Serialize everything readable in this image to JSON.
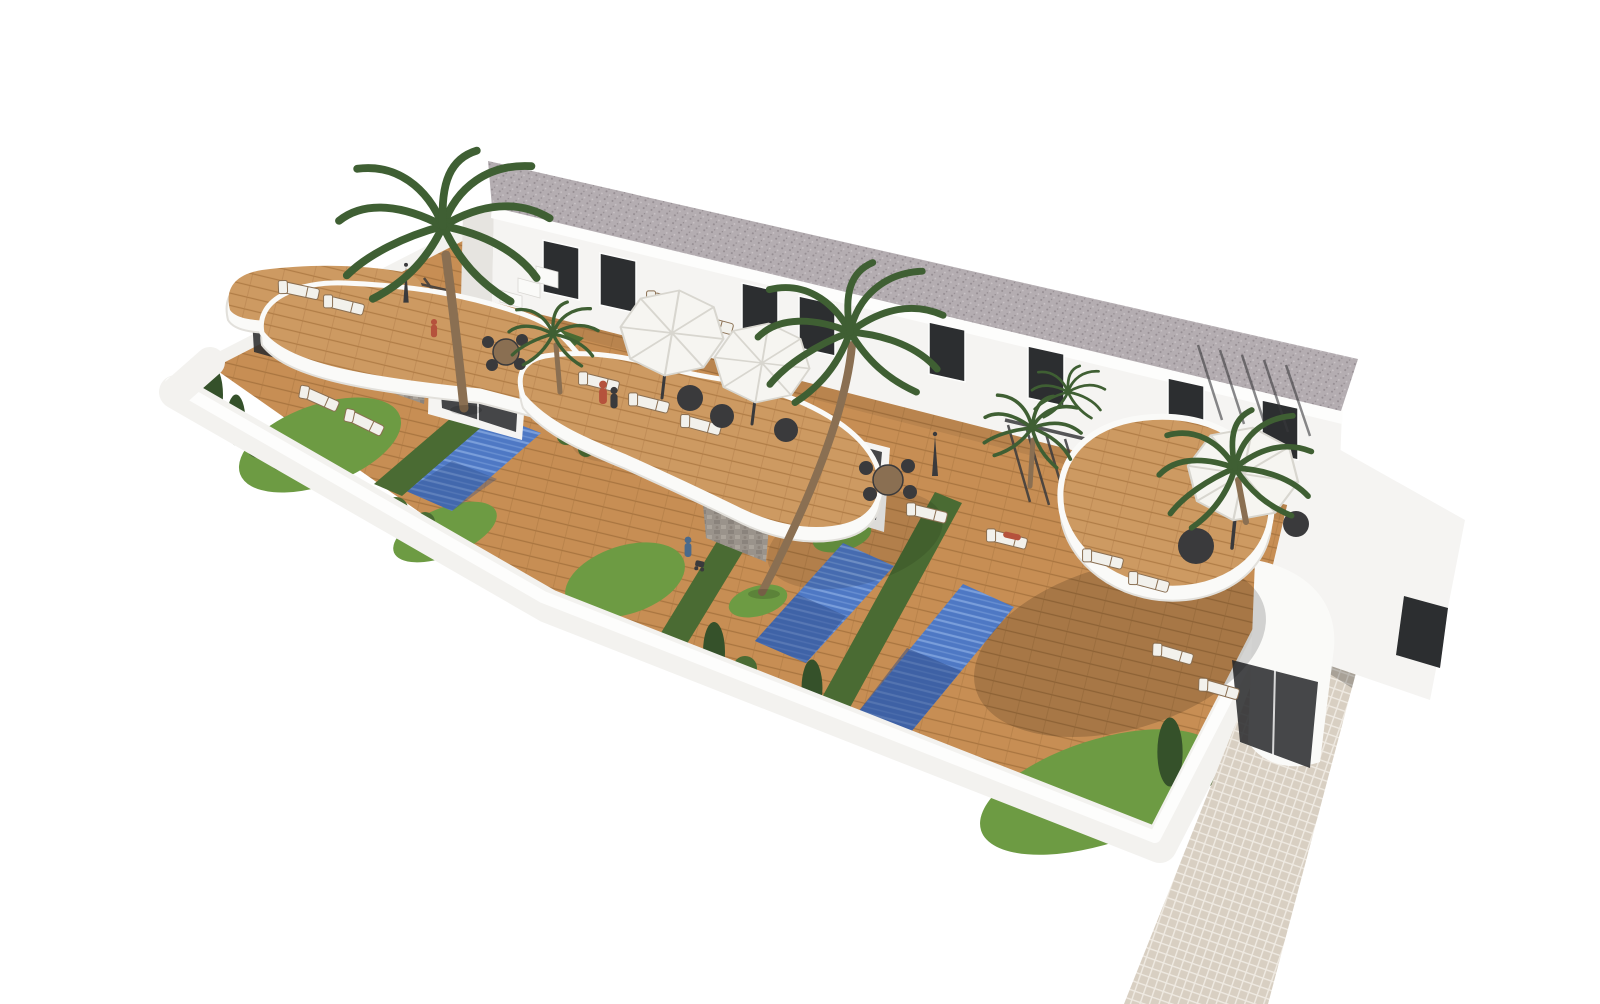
{
  "scene": {
    "type": "architectural-3d-render",
    "description": "Aerial 3D architectural rendering of a modern white two-storey townhouse development: a long flat-roofed block with gravel roof, dark windows, four units with curved white kidney-shaped rooftop terraces clad in wood decking, private gardens with wooden decks, grass patches, dark hedges, three covered blue swimming pools, palm trees, white parasols, sun loungers, a white perimeter wall and a beige tiled walkway along the right side, all floating on a plain white background.",
    "inventory": {
      "residential_blocks": 1,
      "visible_units": 4,
      "swimming_pools": 3,
      "palm_trees": 6,
      "open_parasols": 3,
      "closed_parasols": 2,
      "sun_loungers": 14,
      "people": 5,
      "dining_sets": 2
    }
  },
  "palette": {
    "background": "#ffffff",
    "roof_gravel": "#b4adb1",
    "roof_speckle": "#948c91",
    "roof_speckle_light": "#cac4c7",
    "facade": "#f5f4f2",
    "facade_shadow": "#e6e4e0",
    "cornice_white": "#fdfdfc",
    "window_glass": "#2c2e30",
    "terrace_white": "#fafaf8",
    "terrace_shadow": "#e2e0db",
    "terrace_wood": "#cd9a62",
    "deck_wood": "#c78e54",
    "deck_plank": "#a97540",
    "pool_blue": "#4e78c4",
    "pool_slat": "#85a8e0",
    "pool_shadow": "#2e4a85",
    "grass_green": "#6d9b43",
    "hedge_green": "#4a6b33",
    "hedge_dark": "#35512a",
    "palm_green": "#3f5f33",
    "palm_trunk": "#8a6f52",
    "stone_clad": "#9a938b",
    "stone_dark": "#7d766e",
    "stone_light": "#b6afa5",
    "wall_white": "#f3f2ef",
    "wall_top": "#fdfdfc",
    "wall_edge": "#d9d7d3",
    "tile_beige": "#d8cfc2",
    "tile_grout": "#efeae2",
    "umbrella_white": "#f6f5f1",
    "umbrella_shade": "#d8d6cf",
    "furniture_dark": "#3a3a3c",
    "lounger_white": "#f2f1ec",
    "lounger_frame": "#8a6f52",
    "person_red": "#b5523c",
    "person_blue": "#4a6a8c",
    "shadow": "#000000"
  }
}
